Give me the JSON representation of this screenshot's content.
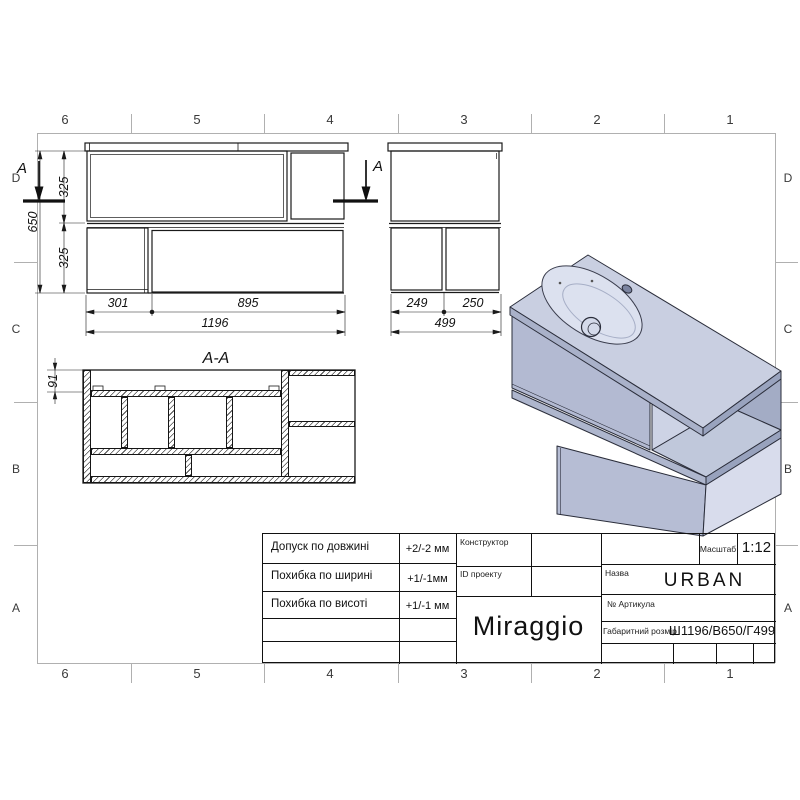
{
  "sheet": {
    "columns": [
      "6",
      "5",
      "4",
      "3",
      "2",
      "1"
    ],
    "rows": [
      "D",
      "C",
      "B",
      "A"
    ]
  },
  "front_view": {
    "dim_301": "301",
    "dim_895": "895",
    "dim_1196": "1196",
    "dim_650": "650",
    "dim_325_upper": "325",
    "dim_325_lower": "325",
    "section_label_left": "A",
    "section_label_right": "A"
  },
  "side_view": {
    "dim_249": "249",
    "dim_250": "250",
    "dim_499": "499"
  },
  "section_view": {
    "title": "A-A",
    "dim_91": "91"
  },
  "title_block": {
    "tolerances": [
      {
        "label": "Допуск по довжині",
        "value": "+2/-2 мм"
      },
      {
        "label": "Похибка по ширині",
        "value": "+1/-1мм"
      },
      {
        "label": "Похибка по висоті",
        "value": "+1/-1 мм"
      }
    ],
    "constructor_label": "Конструктор",
    "project_id_label": "ID проекту",
    "brand": "Miraggio",
    "scale_label": "Масштаб",
    "scale_value": "1:12",
    "name_label": "Назва",
    "name_value": "URBAN",
    "article_label": "№  Артикула",
    "size_label": "Габаритний розмір",
    "size_value": "Ш1196/В650/Г499"
  },
  "colors": {
    "line": "#1a1a1a",
    "frame_gray": "#b0b0b0",
    "iso_top": "#c9cfe1",
    "iso_front": "#b3bad2",
    "iso_side_light": "#d8dcec",
    "iso_interior_dark": "#a3acc5"
  }
}
